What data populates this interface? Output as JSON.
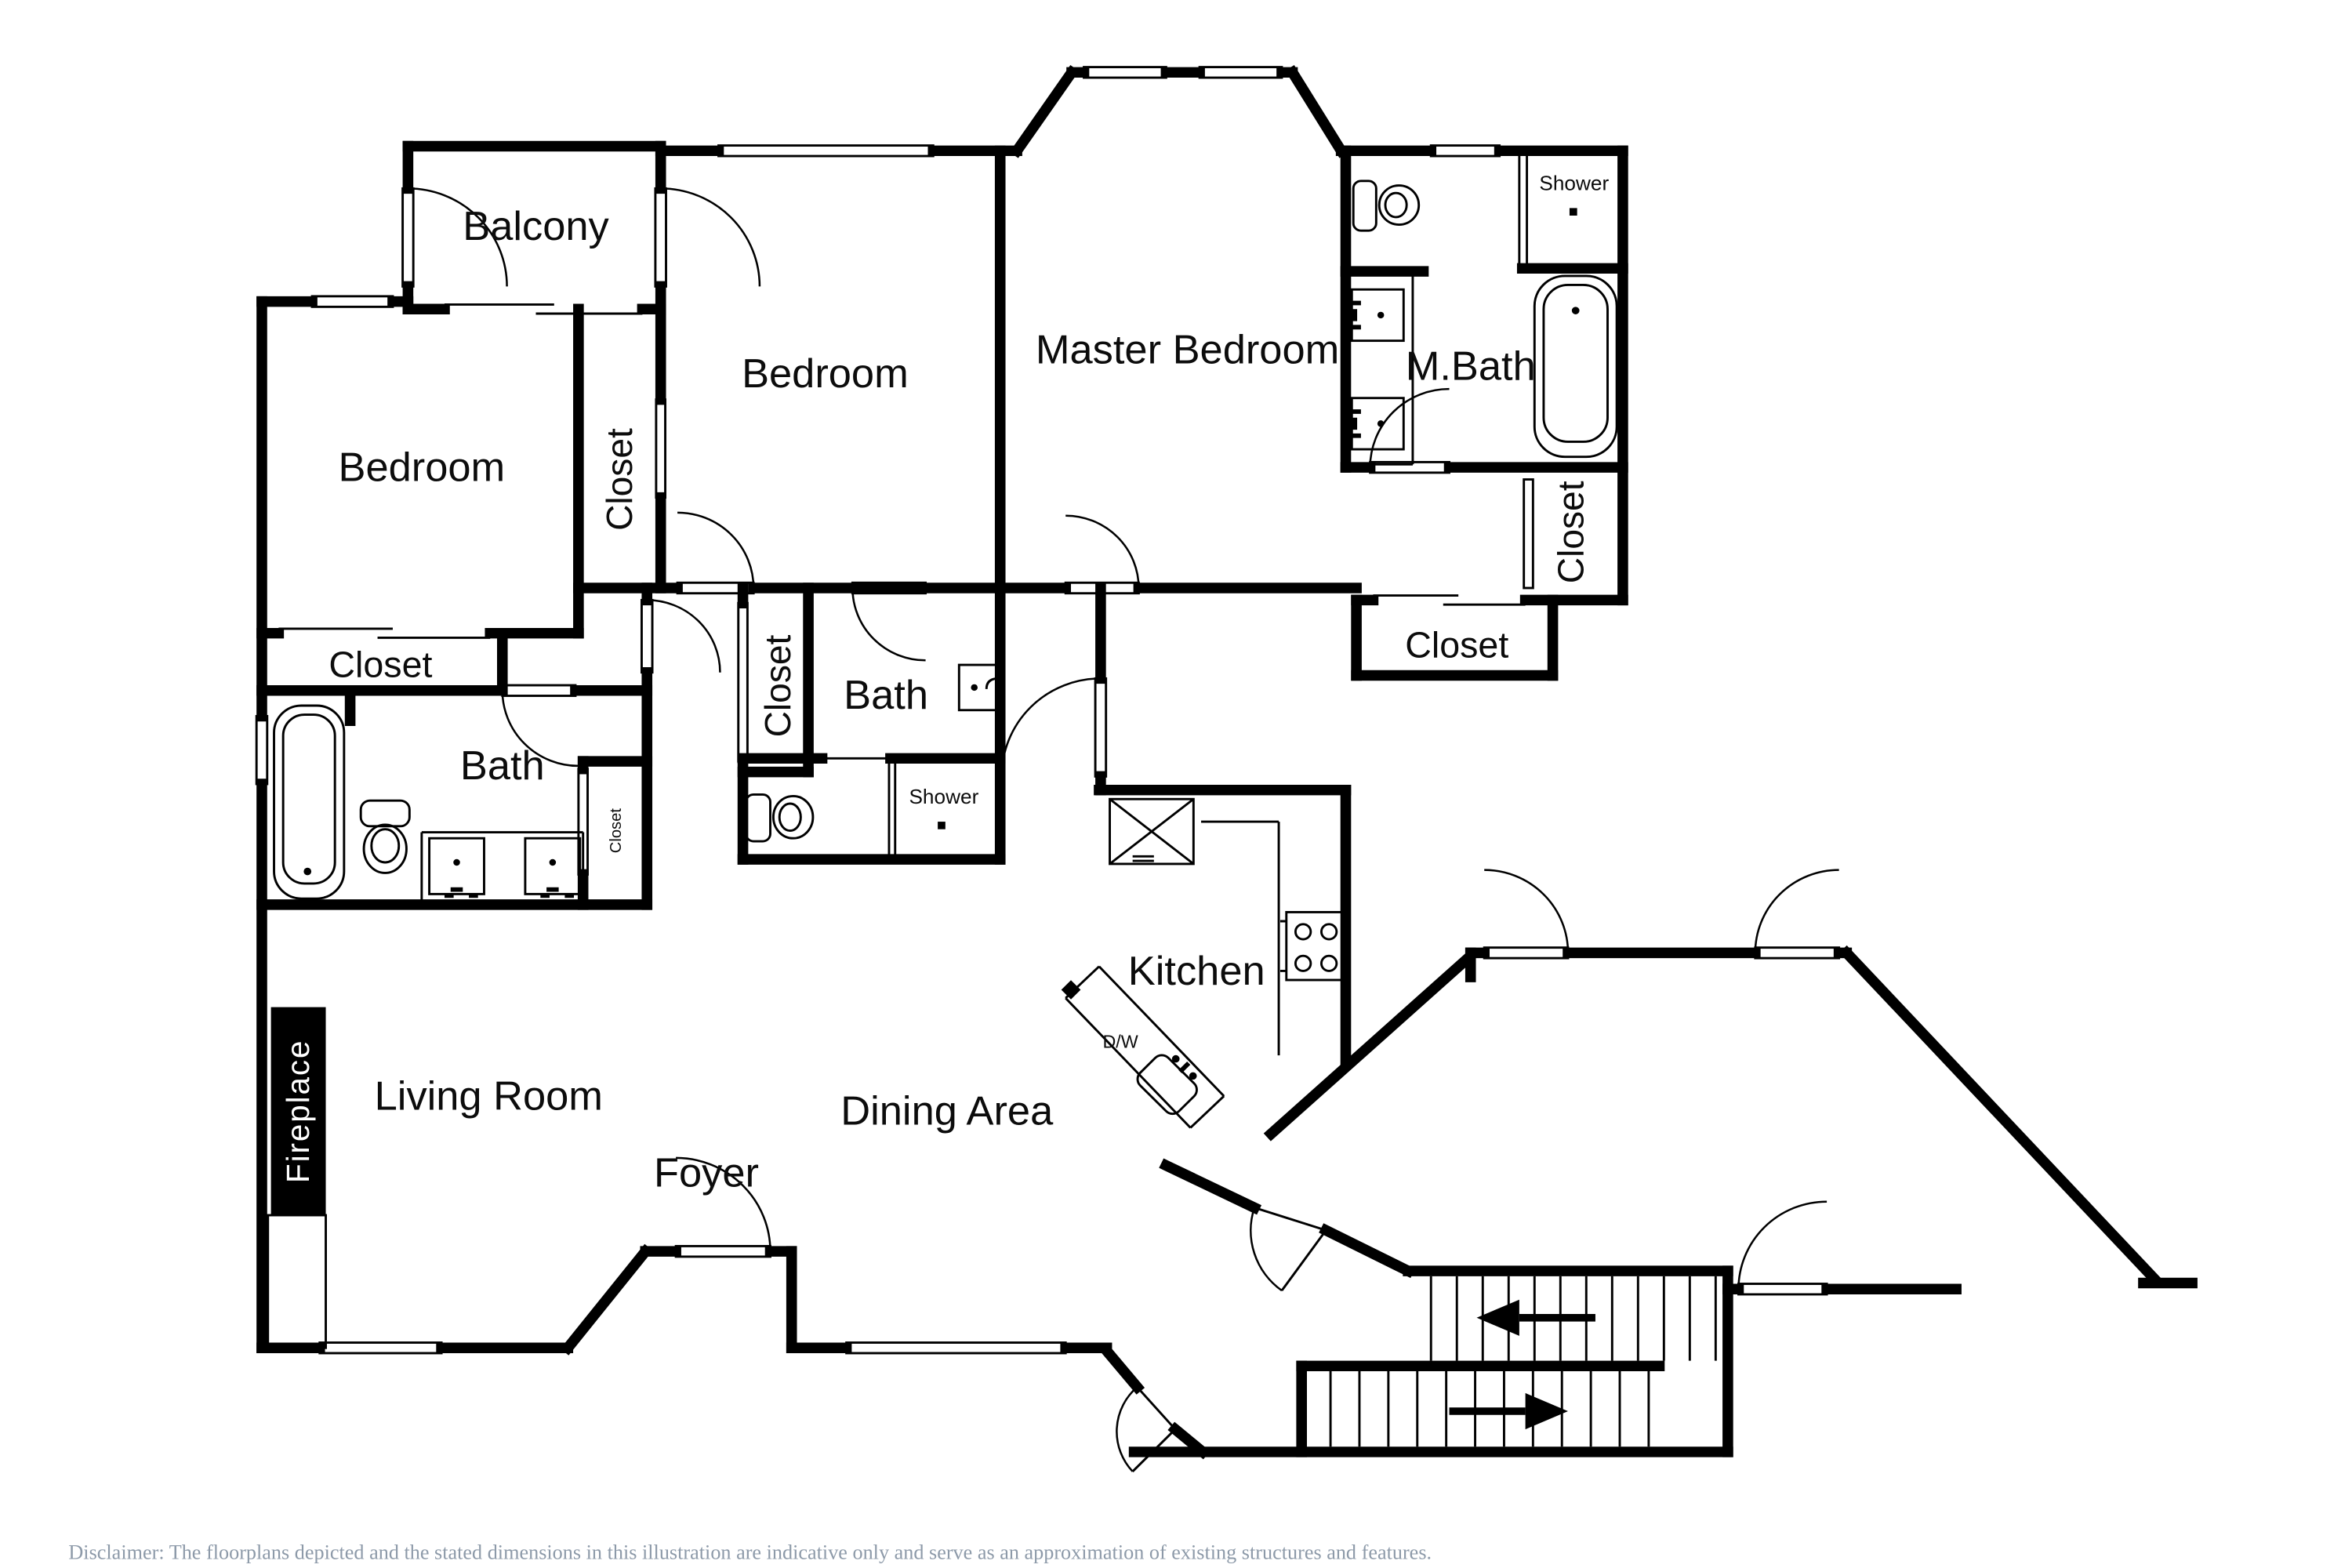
{
  "colors": {
    "wall": "#000000",
    "background": "#ffffff",
    "disclaimer_text": "#8d9aa9"
  },
  "labels": {
    "balcony": "Balcony",
    "bedroom_left": "Bedroom",
    "bedroom_center": "Bedroom",
    "master_bedroom": "Master Bedroom",
    "m_bath": "M.Bath",
    "m_bath_shower": "Shower",
    "closet_walkin": "Closet",
    "closet_below_master": "Closet",
    "closet_between_bedrooms": "Closet",
    "closet_center_hall": "Closet",
    "closet_left": "Closet",
    "closet_bath_small": "Closet",
    "bath_left": "Bath",
    "bath_center": "Bath",
    "shower_center": "Shower",
    "kitchen": "Kitchen",
    "dishwasher": "D/W",
    "dining_area": "Dining Area",
    "living_room": "Living Room",
    "foyer": "Foyer",
    "fireplace": "Fireplace"
  },
  "footer": {
    "disclaimer": "Disclaimer: The floorplans depicted and the stated dimensions in this illustration are indicative only and serve as an approximation of existing structures and features."
  }
}
